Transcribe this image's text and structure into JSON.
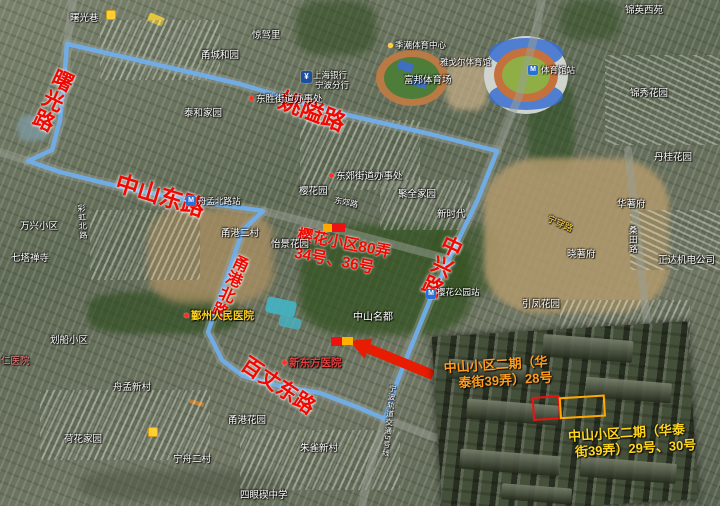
{
  "map": {
    "route": {
      "color": "#70aeea",
      "points": [
        [
          67,
          44
        ],
        [
          150,
          63
        ],
        [
          240,
          84
        ],
        [
          330,
          111
        ],
        [
          430,
          134
        ],
        [
          497,
          151
        ],
        [
          478,
          199
        ],
        [
          452,
          253
        ],
        [
          430,
          300
        ],
        [
          409,
          352
        ],
        [
          396,
          385
        ],
        [
          385,
          419
        ],
        [
          357,
          407
        ],
        [
          320,
          393
        ],
        [
          280,
          386
        ],
        [
          243,
          376
        ],
        [
          222,
          360
        ],
        [
          208,
          332
        ],
        [
          222,
          291
        ],
        [
          243,
          230
        ],
        [
          263,
          211
        ],
        [
          195,
          201
        ],
        [
          140,
          191
        ],
        [
          100,
          182
        ],
        [
          60,
          172
        ],
        [
          28,
          161
        ],
        [
          52,
          150
        ],
        [
          60,
          120
        ],
        [
          64,
          82
        ],
        [
          67,
          44
        ]
      ]
    },
    "gray_roads": [
      [
        [
          497,
          151
        ],
        [
          519,
          96
        ],
        [
          536,
          30
        ],
        [
          542,
          0
        ]
      ],
      [
        [
          385,
          419
        ],
        [
          430,
          436
        ],
        [
          520,
          456
        ],
        [
          620,
          472
        ]
      ],
      [
        [
          385,
          419
        ],
        [
          370,
          468
        ],
        [
          362,
          506
        ]
      ],
      [
        [
          28,
          161
        ],
        [
          0,
          152
        ]
      ],
      [
        [
          67,
          44
        ],
        [
          73,
          0
        ]
      ],
      [
        [
          263,
          211
        ],
        [
          350,
          233
        ],
        [
          445,
          258
        ]
      ],
      [
        [
          628,
          150
        ],
        [
          640,
          260
        ],
        [
          648,
          330
        ]
      ]
    ],
    "arrow": {
      "x1": 433,
      "y1": 375,
      "x2": 350,
      "y2": 341,
      "color": "#e81c00"
    },
    "highlight_rects": [
      {
        "x": 323,
        "y": 224,
        "w": 9,
        "h": 8,
        "color": "#ffa800"
      },
      {
        "x": 332,
        "y": 223,
        "w": 13,
        "h": 9,
        "color": "#ee1111"
      },
      {
        "x": 331,
        "y": 337,
        "w": 11,
        "h": 9,
        "color": "#ee1111"
      },
      {
        "x": 342,
        "y": 337,
        "w": 11,
        "h": 8,
        "color": "#ffb300"
      }
    ],
    "labels": [
      {
        "text": "曙光路",
        "x": 52,
        "y": 100,
        "size": 21,
        "rot": 25,
        "cls": "red-road",
        "v": true,
        "anchor": "c"
      },
      {
        "text": "中山东路",
        "x": 160,
        "y": 196,
        "size": 23,
        "rot": 17,
        "cls": "red-road",
        "anchor": "c"
      },
      {
        "text": "姚隘路",
        "x": 312,
        "y": 112,
        "size": 23,
        "rot": 21,
        "cls": "red-road",
        "anchor": "c"
      },
      {
        "text": "中兴路",
        "x": 441,
        "y": 266,
        "size": 21,
        "rot": 25,
        "cls": "red-road",
        "v": true,
        "anchor": "c"
      },
      {
        "text": "甬港北路",
        "x": 228,
        "y": 286,
        "size": 16,
        "rot": 24,
        "cls": "red-road",
        "v": true,
        "anchor": "c"
      },
      {
        "text": "百丈东路",
        "x": 278,
        "y": 386,
        "size": 21,
        "rot": 34,
        "cls": "red-road",
        "anchor": "c"
      },
      {
        "text": "樱花小区80弄",
        "x": 344,
        "y": 244,
        "size": 15.5,
        "rot": 11,
        "cls": "note",
        "anchor": "c"
      },
      {
        "text": "34号、36号",
        "x": 334,
        "y": 261,
        "size": 15.5,
        "rot": 11,
        "cls": "note",
        "anchor": "c"
      },
      {
        "text": "曙光巷",
        "x": 70,
        "y": 14
      },
      {
        "text": "甬城和园",
        "x": 201,
        "y": 51
      },
      {
        "text": "惊驾里",
        "x": 252,
        "y": 31
      },
      {
        "text": "泰和家园",
        "x": 184,
        "y": 109
      },
      {
        "text": "锦英西苑",
        "x": 625,
        "y": 6
      },
      {
        "text": "锦秀花园",
        "x": 630,
        "y": 89
      },
      {
        "text": "丹桂花园",
        "x": 654,
        "y": 153
      },
      {
        "text": "华著府",
        "x": 617,
        "y": 200
      },
      {
        "text": "晓著府",
        "x": 567,
        "y": 250
      },
      {
        "text": "正达机电公司",
        "x": 658,
        "y": 256
      },
      {
        "text": "引凤花园",
        "x": 522,
        "y": 300
      },
      {
        "text": "聚全家园",
        "x": 398,
        "y": 190
      },
      {
        "text": "新时代",
        "x": 437,
        "y": 210
      },
      {
        "text": "樱花园",
        "x": 299,
        "y": 187
      },
      {
        "text": "甬港二村",
        "x": 221,
        "y": 229
      },
      {
        "text": "怡景花园",
        "x": 271,
        "y": 240
      },
      {
        "text": "万兴小区",
        "x": 20,
        "y": 222
      },
      {
        "text": "七塔禅寺",
        "x": 11,
        "y": 254
      },
      {
        "text": "划船小区",
        "x": 50,
        "y": 336
      },
      {
        "text": "舟孟新村",
        "x": 113,
        "y": 383
      },
      {
        "text": "荷花家园",
        "x": 64,
        "y": 435
      },
      {
        "text": "甬港花园",
        "x": 228,
        "y": 416
      },
      {
        "text": "宁舟二村",
        "x": 173,
        "y": 455
      },
      {
        "text": "朱雀新村",
        "x": 300,
        "y": 444
      },
      {
        "text": "四眼碶中学",
        "x": 240,
        "y": 491
      },
      {
        "text": "中山名都",
        "x": 353,
        "y": 313,
        "size": 10
      },
      {
        "text": "富邦体育场",
        "x": 404,
        "y": 76
      },
      {
        "text": "樱花公园站",
        "x": 437,
        "y": 288,
        "size": 8.5
      },
      {
        "text": "雅戈尔体育馆",
        "x": 440,
        "y": 58,
        "size": 8.5
      },
      {
        "text": "季潮体育中心",
        "x": 388,
        "y": 41,
        "size": 8.5,
        "dot": "#ffcf33"
      },
      {
        "text": "上海银行",
        "x": 313,
        "y": 71,
        "size": 8.5
      },
      {
        "text": "宁波分行",
        "x": 315,
        "y": 81,
        "size": 8.5
      },
      {
        "text": "东胜街道办事处",
        "x": 249,
        "y": 95,
        "dot": "#ff3020"
      },
      {
        "text": "东郊街道办事处",
        "x": 329,
        "y": 172,
        "dot": "#ff3020"
      },
      {
        "text": "鄞州人民医院",
        "x": 184,
        "y": 311,
        "size": 10.5,
        "color": "#ffd21e",
        "bold": true,
        "dot": "#ff3020"
      },
      {
        "text": "新东方医院",
        "x": 282,
        "y": 358,
        "size": 10.5,
        "color": "#e84040",
        "bold": true,
        "dot": "#ff3020"
      },
      {
        "text": "仁医院",
        "x": 1,
        "y": 357,
        "color": "#ff8585"
      },
      {
        "text": "舟孟北路站",
        "x": 198,
        "y": 197,
        "size": 8.5
      },
      {
        "text": "体育馆站",
        "x": 541,
        "y": 66,
        "size": 8.5
      },
      {
        "text": "彩虹北路",
        "x": 82,
        "y": 222,
        "size": 8,
        "rot": -4,
        "v": true,
        "anchor": "c"
      },
      {
        "text": "桑田路",
        "x": 633,
        "y": 240,
        "size": 8.5,
        "v": true,
        "anchor": "c"
      },
      {
        "text": "东郊路",
        "x": 346,
        "y": 203,
        "size": 8,
        "rot": 12,
        "anchor": "c"
      },
      {
        "text": "宁穿路",
        "x": 560,
        "y": 224,
        "size": 9,
        "rot": 24,
        "cls": "y-street",
        "anchor": "c"
      },
      {
        "text": "宁波轨道交通5号线",
        "x": 389,
        "y": 421,
        "size": 7.5,
        "rot": 6,
        "v": true,
        "anchor": "c"
      }
    ],
    "icons": [
      {
        "type": "metro",
        "glyph": "M",
        "x": 186,
        "y": 196
      },
      {
        "type": "metro",
        "glyph": "M",
        "x": 528,
        "y": 65
      },
      {
        "type": "metro",
        "glyph": "M",
        "x": 426,
        "y": 289
      },
      {
        "type": "bank",
        "glyph": "¥",
        "x": 301,
        "y": 71
      },
      {
        "type": "poi-y",
        "x": 148,
        "y": 427
      },
      {
        "type": "poi-y",
        "x": 106,
        "y": 10
      }
    ]
  },
  "inset": {
    "caption_orange_l1": "中山小区二期（华",
    "caption_orange_l2": "泰街39弄）28号",
    "caption_yellow_l1": "中山小区二期（华泰",
    "caption_yellow_l2": "街39弄）29号、30号",
    "rect_red": {
      "x": 96,
      "y": 66,
      "w": 24,
      "h": 20,
      "color": "#ee1111"
    },
    "rect_orange": {
      "x": 123,
      "y": 68,
      "w": 42,
      "h": 18,
      "color": "#ffaa00"
    }
  }
}
